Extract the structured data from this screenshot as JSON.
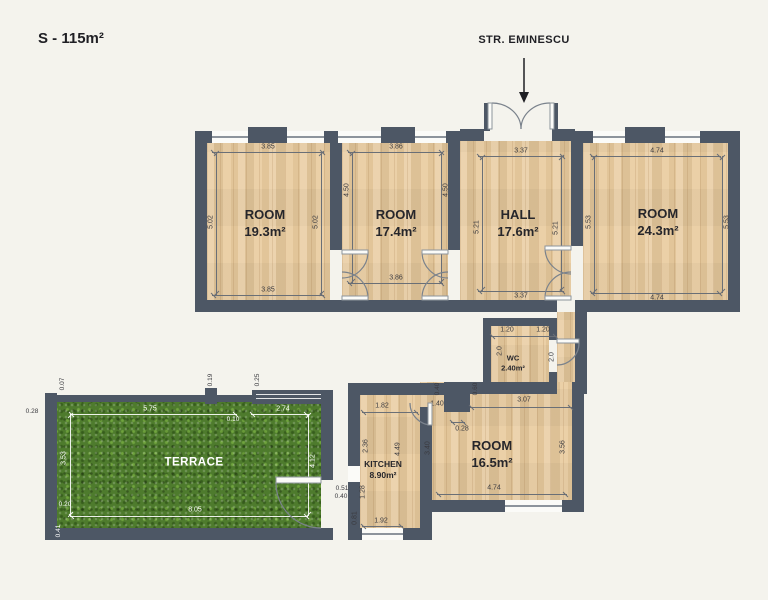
{
  "title": "S - 115m²",
  "street": {
    "label": "STR. EMINESCU"
  },
  "colors": {
    "wall": "#4d5765",
    "wood": "#e9cb9e",
    "grass": "#4e7b2d",
    "background": "#f4f3ed",
    "dim_line": "#6a6f76"
  },
  "rooms": {
    "room1": {
      "name": "ROOM",
      "area": "19.3m²",
      "top": "3.85",
      "bottom": "3.85",
      "left": "5.02",
      "right": "5.02"
    },
    "room2": {
      "name": "ROOM",
      "area": "17.4m²",
      "top": "3.86",
      "bottom": "3.86",
      "left": "4.50",
      "right": "4.50"
    },
    "hall": {
      "name": "HALL",
      "area": "17.6m²",
      "top": "3.37",
      "bottom": "3.37",
      "left": "5.21",
      "right": "5.21"
    },
    "room4": {
      "name": "ROOM",
      "area": "24.3m²",
      "top": "4.74",
      "bottom": "4.74",
      "left": "5.53",
      "right": "5.53"
    },
    "wc": {
      "name": "WC",
      "area": "2.40m²",
      "top_left": "1.20",
      "top_right": "1.20",
      "left": "2.0",
      "right": "2.0"
    },
    "room5": {
      "name": "ROOM",
      "area": "16.5m²",
      "top": "3.07",
      "bottom": "4.74",
      "left": "3.40",
      "right": "3.56",
      "notch_width": "1.40",
      "notch_gap": "0.28",
      "notch_a": "0.40",
      "notch_b": "0.60"
    },
    "kitchen": {
      "name": "KITCHEN",
      "area": "8.90m²",
      "top": "1.82",
      "left_upper": "2.36",
      "inner": "4.49",
      "left_lower": "1.28",
      "bottom": "1.92",
      "bottom_left": "0.81",
      "door_a": "0.51",
      "door_b": "0.40"
    },
    "terrace": {
      "name": "TERRACE",
      "top_left": "5.75",
      "top_right": "2.74",
      "left": "3.53",
      "right": "4.12",
      "bottom": "8.05",
      "edge_top": "0.07",
      "edge_left": "0.28",
      "pillar_a": "0.19",
      "pillar_b": "0.25",
      "gap": "0.10",
      "corner": "0.20",
      "corner_b": "0.41"
    }
  }
}
